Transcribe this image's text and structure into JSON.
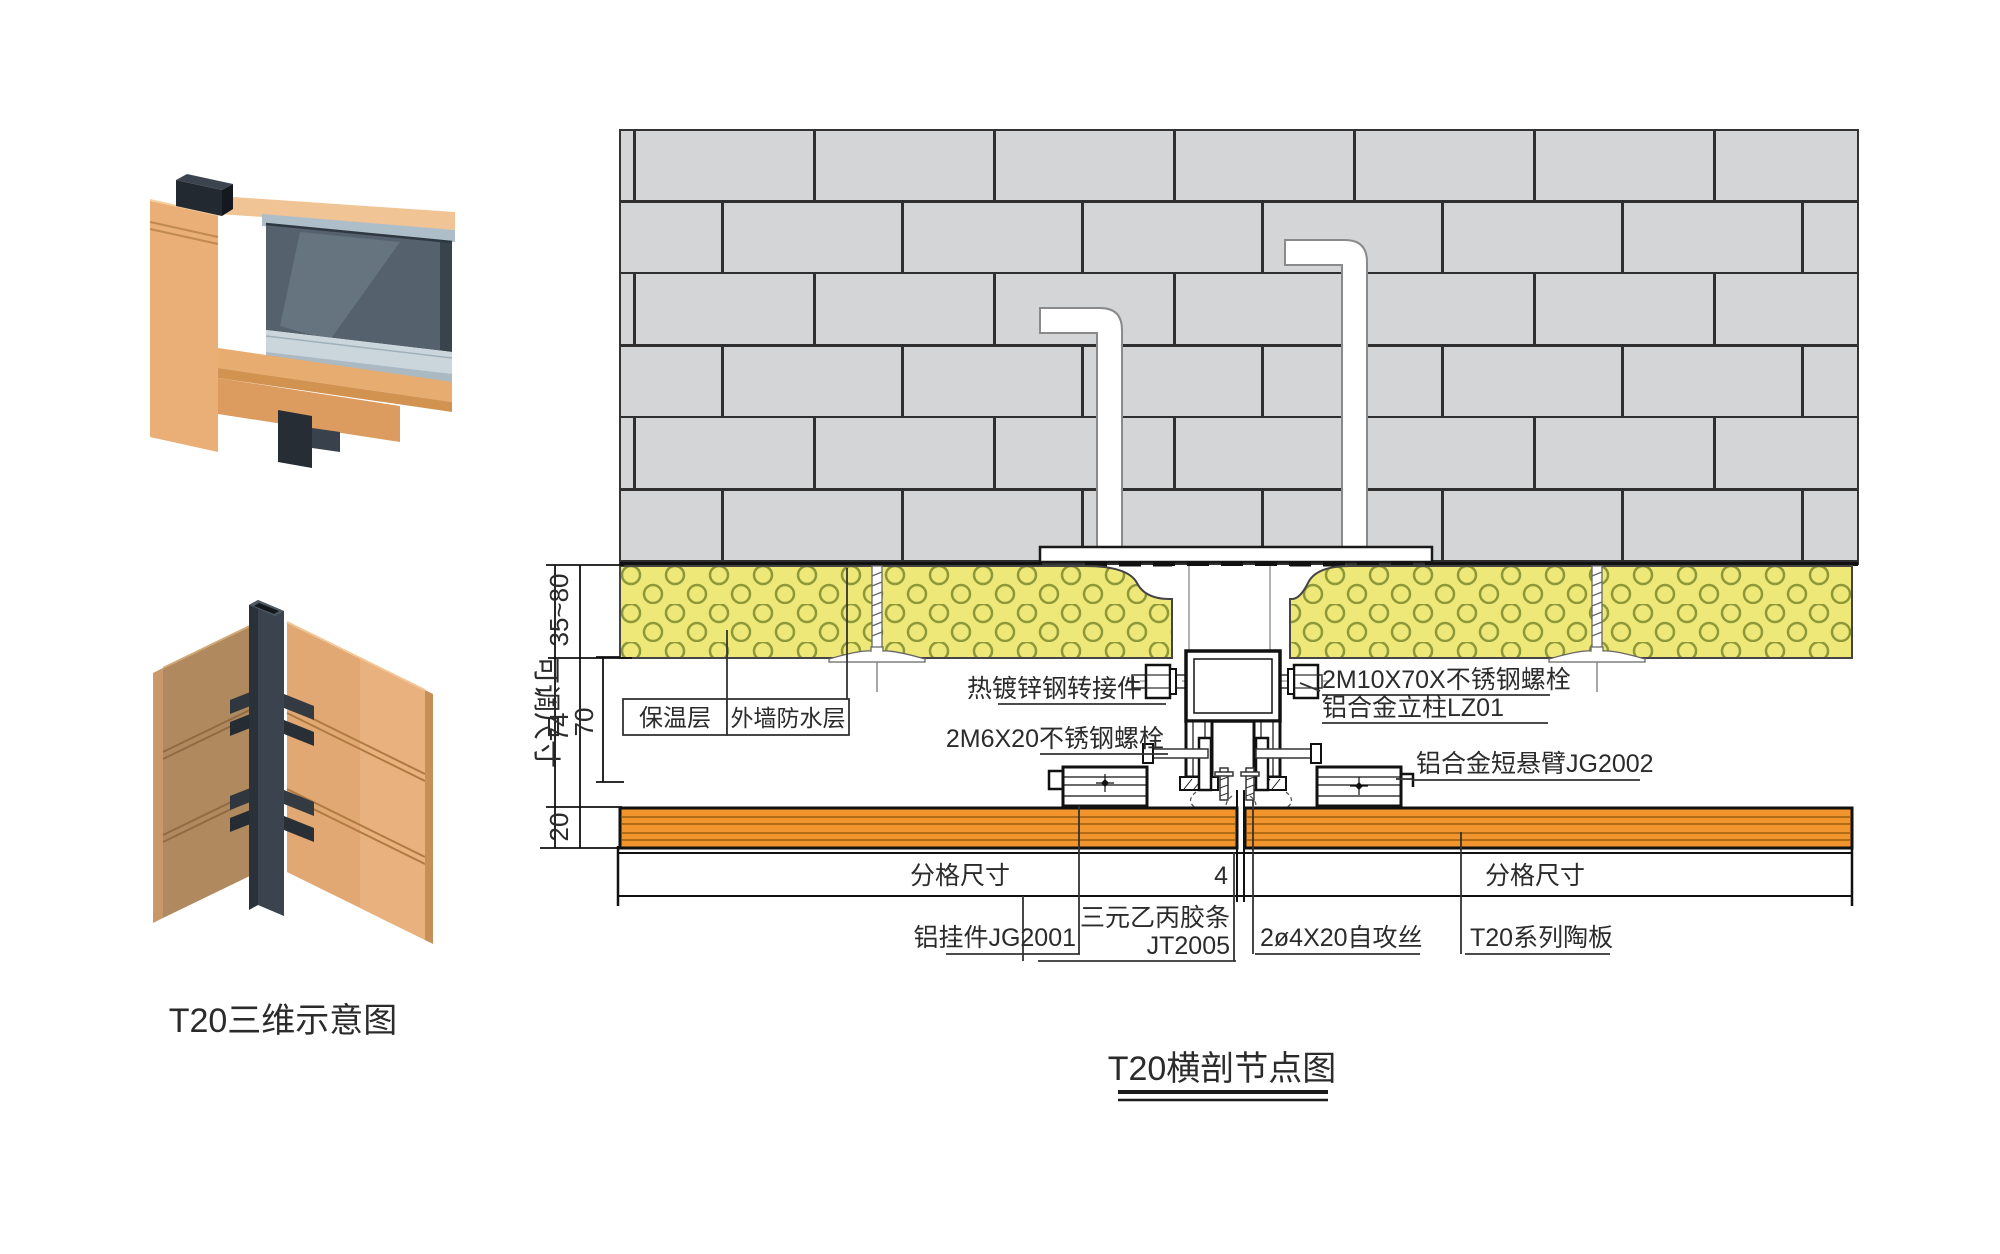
{
  "titles": {
    "left_3d": "T20三维示意图",
    "section": "T20横剖节点图"
  },
  "dims": {
    "adjustable": "可调尺寸",
    "insulation_range": "35~80",
    "d74": "74",
    "d70": "70",
    "d20": "20",
    "module_left": "分格尺寸",
    "gap": "4",
    "module_right": "分格尺寸"
  },
  "labels": {
    "insulation": "保温层",
    "waterproof": "外墙防水层",
    "adapter": "热镀锌钢转接件",
    "bolt_m6": "2M6X20不锈钢螺栓",
    "bolt_m10": "2M10X70X不锈钢螺栓",
    "mullion": "铝合金立柱LZ01",
    "short_arm": "铝合金短悬臂JG2002",
    "hanger": "铝挂件JG2001",
    "epdm_line1": "三元乙丙胶条",
    "epdm_line2": "JT2005",
    "screw": "2ø4X20自攻丝",
    "panel": "T20系列陶板"
  },
  "colors": {
    "brick_gray": "#D4D5D6",
    "insulation_yellow": "#EDE878",
    "insulation_ring": "#8E9838",
    "panel_orange": "#F2952D",
    "terracotta_light": "#E2A873",
    "terracotta_shade": "#B1895E",
    "mullion_dark": "#3B444E",
    "glass": "#55616C",
    "line": "#111111"
  }
}
